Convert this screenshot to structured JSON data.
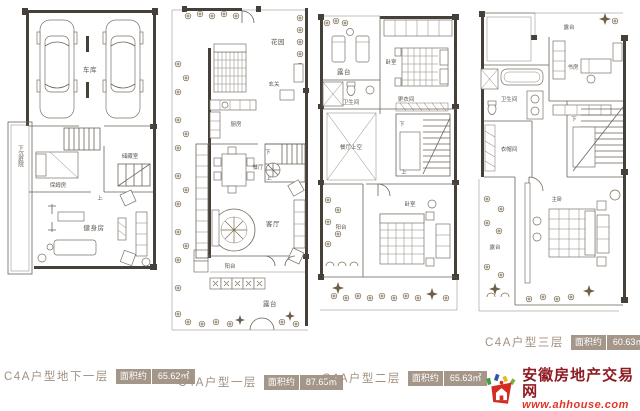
{
  "colors": {
    "line": "#6b635a",
    "wall": "#46403a",
    "room_label": "#5d564e",
    "title_text": "#a29181",
    "badge_bg": "#a5968a",
    "badge_text": "#ffffff",
    "logo_name_color": "#8e1b21",
    "logo_url_color": "#e2352b",
    "plant": "#7a6a50"
  },
  "plans": [
    {
      "id": "basement",
      "title": "C4A户型地下一层",
      "area_prefix": "面积约",
      "area_value": "65.62㎡",
      "rooms": [
        {
          "label": "车库"
        },
        {
          "label": "储藏室"
        },
        {
          "label": "保姆房"
        },
        {
          "label": "健身房"
        },
        {
          "label": "下沉庭院"
        },
        {
          "label": "上"
        }
      ]
    },
    {
      "id": "floor-1",
      "title": "C4A户型一层",
      "area_prefix": "面积约",
      "area_value": "87.65㎡",
      "rooms": [
        {
          "label": "花园"
        },
        {
          "label": "玄关"
        },
        {
          "label": "厨房"
        },
        {
          "label": "餐厅"
        },
        {
          "label": "客厅"
        },
        {
          "label": "阳台"
        },
        {
          "label": "露台"
        },
        {
          "label": "下"
        },
        {
          "label": "上"
        }
      ]
    },
    {
      "id": "floor-2",
      "title": "C4A户型二层",
      "area_prefix": "面积约",
      "area_value": "65.63㎡",
      "rooms": [
        {
          "label": "露台"
        },
        {
          "label": "卧室"
        },
        {
          "label": "卫生间"
        },
        {
          "label": "更衣间"
        },
        {
          "label": "餐厅上空"
        },
        {
          "label": "阳台"
        },
        {
          "label": "卧室"
        },
        {
          "label": "下"
        },
        {
          "label": "上"
        }
      ]
    },
    {
      "id": "floor-3",
      "title": "C4A户型三层",
      "area_prefix": "面积约",
      "area_value": "60.63㎡",
      "rooms": [
        {
          "label": "露台"
        },
        {
          "label": "书房"
        },
        {
          "label": "卫生间"
        },
        {
          "label": "衣帽间"
        },
        {
          "label": "主卧"
        },
        {
          "label": "露台"
        },
        {
          "label": "下"
        }
      ]
    }
  ],
  "logo": {
    "site_name": "安徽房地产交易网",
    "site_url": "www.ahhouse.com"
  }
}
